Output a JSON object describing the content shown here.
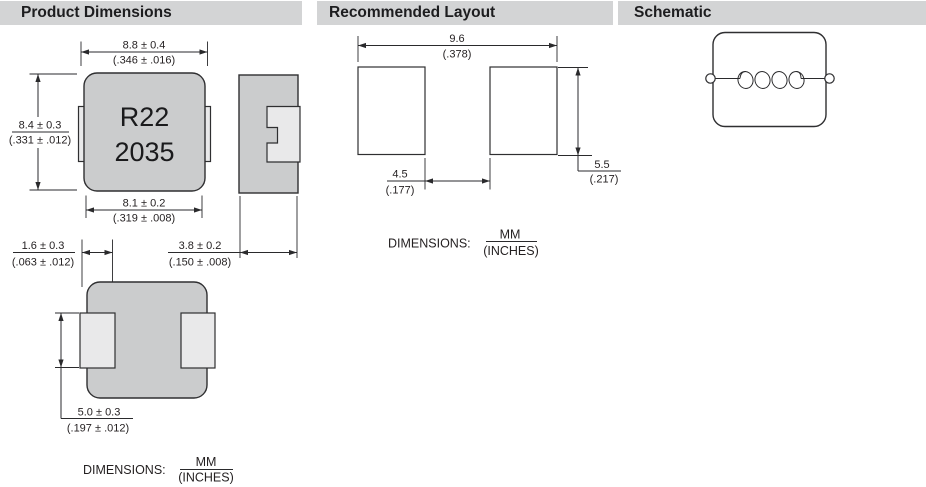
{
  "sections": {
    "product_dimensions": {
      "title": "Product Dimensions"
    },
    "recommended_layout": {
      "title": "Recommended Layout"
    },
    "schematic": {
      "title": "Schematic"
    }
  },
  "part_marking": {
    "line1": "R22",
    "line2": "2035"
  },
  "product_dims": {
    "top_width_mm": "8.8 ± 0.4",
    "top_width_in": "(.346 ± .016)",
    "height_mm": "8.4 ± 0.3",
    "height_in": "(.331 ± .012)",
    "bottom_width_mm": "8.1 ± 0.2",
    "bottom_width_in": "(.319 ± .008)",
    "side_thickness_mm": "3.8 ± 0.2",
    "side_thickness_in": "(.150 ± .008)",
    "terminal_width_mm": "1.6 ± 0.3",
    "terminal_width_in": "(.063 ± .012)",
    "terminal_length_mm": "5.0 ± 0.3",
    "terminal_length_in": "(.197 ± .012)"
  },
  "layout_dims": {
    "span_mm": "9.6",
    "span_in": "(.378)",
    "gap_mm": "4.5",
    "gap_in": "(.177)",
    "pad_height_mm": "5.5",
    "pad_height_in": "(.217)"
  },
  "units_note": {
    "label": "DIMENSIONS:",
    "numerator": "MM",
    "denominator": "(INCHES)"
  },
  "colors": {
    "header_bg": "#d3d4d5",
    "body_fill": "#cbcccd",
    "terminal_fill": "#e9e9ea",
    "pad_fill": "#ffffff",
    "line": "#2a2a2c",
    "text": "#231f20"
  }
}
